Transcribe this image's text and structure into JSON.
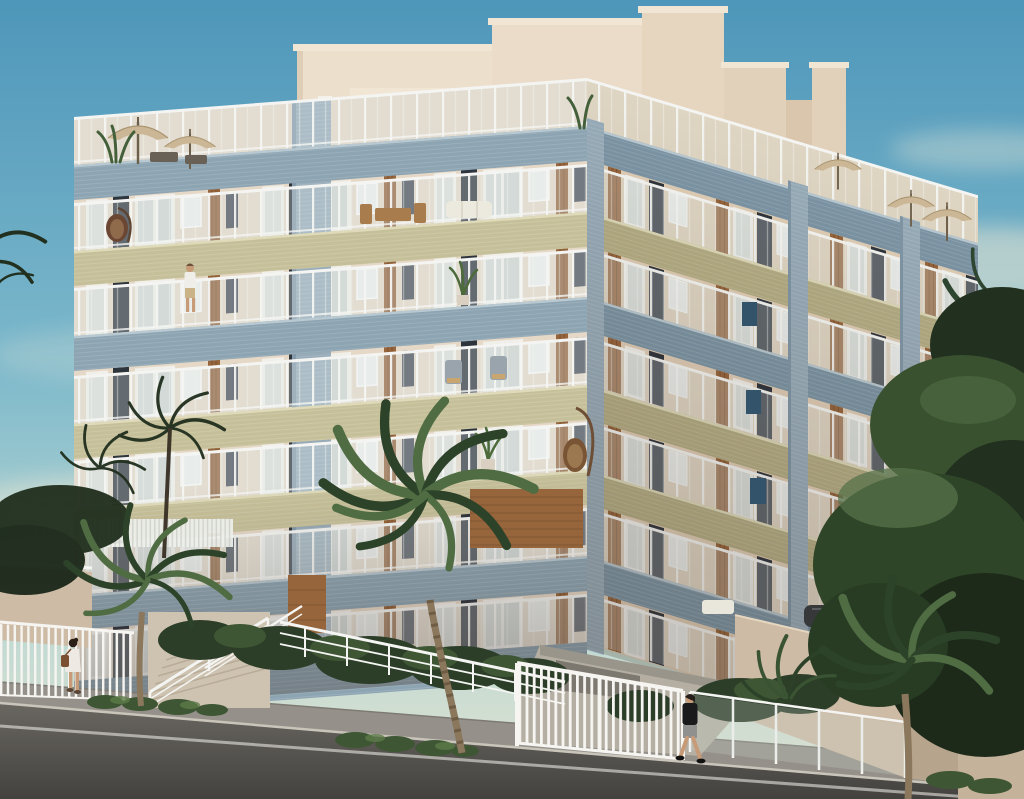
{
  "meta": {
    "type": "architectural-rendering",
    "width": 1024,
    "height": 799
  },
  "scene": {
    "setting": "Seaside apartment building rendering at dusk, corner street view",
    "building": {
      "kind": "multi-storey residential apartment block",
      "floors_visible": 7,
      "view": "two facades from street corner",
      "rooftop_terrace": true,
      "balcony_band_sequence": [
        "blue",
        "olive",
        "blue",
        "olive",
        "olive",
        "blue",
        "blue"
      ],
      "railing_style": "white posts with glass panels",
      "materials": [
        "cream brick",
        "blue-gray mosaic tile",
        "olive mosaic tile",
        "wood slat panels"
      ]
    },
    "rooftop": {
      "umbrellas": 5,
      "umbrella_color": "tan",
      "plants": true,
      "outdoor_furniture": true
    },
    "people": [
      {
        "id": "woman-walking",
        "description": "woman in white dress with brown shoulder bag walking on left sidewalk"
      },
      {
        "id": "man-walking",
        "description": "man in black t-shirt and gray shorts walking past entrance gate"
      },
      {
        "id": "man-on-balcony",
        "description": "man in white shirt standing on upper balcony"
      }
    ],
    "balcony_items": [
      "hanging egg chair",
      "tall-stand egg chair",
      "potted plants",
      "wooden dining set",
      "white sofa",
      "lounge chairs"
    ],
    "vegetation": {
      "foreground_palms": 3,
      "distant_palms": true,
      "dense_trees_right": true,
      "shrub_rows": true
    },
    "street": {
      "road": "asphalt with white edge line",
      "sidewalk": true,
      "stairs_to_entrance": true,
      "driveway_ramp": true,
      "parked_car_partially_hidden": true,
      "fences": [
        "white vertical-bar fence",
        "white entrance gate",
        "three-rail ramp railing",
        "glass panel fence"
      ]
    },
    "sky": {
      "condition": "clear with soft warm clouds"
    }
  },
  "palette": {
    "skyTop": "#4e96ba",
    "skyMid": "#7cb8cb",
    "skyLow": "#b9d7d2",
    "horizon": "#e2e3d2",
    "cloud": "#f0edda",
    "wallFront": "#e6d8c6",
    "wallFrontDark": "#d6c5ae",
    "wallRight": "#dfcdb5",
    "wallRightDark": "#c9b59b",
    "roofCream": "#ecdfcc",
    "roofShade": "#d9c5a9",
    "slab": "#f1e6d4",
    "bandBlue": "#8da4b2",
    "bandBlueDark": "#7b94a4",
    "bandBlueLite": "#b9c9d1",
    "bandOlive": "#c6c09a",
    "bandOliveDark": "#b3ac83",
    "bandOliveLite": "#dedaba",
    "colBlue": "#97abb8",
    "railWhite": "#f4f5f2",
    "glass": "#dfe9ea",
    "winDark": "#2e343c",
    "winDark2": "#454b54",
    "doorWhite": "#f1efe9",
    "wood": "#96653c",
    "woodDark": "#714a2b",
    "terrWall": "#cdbba5",
    "terrWallDark": "#b7a48d",
    "steps": "#cec3b1",
    "path": "#b5afa3",
    "ramp": "#7d786f",
    "sidewalk": "#95918a",
    "curb": "#c9c5ba",
    "road": "#6b6862",
    "roadDark": "#44423f",
    "roadLine": "#e8e6e0",
    "fenceWhite": "#f6f5f1",
    "shrubDark": "#2c3d28",
    "shrubMid": "#3e5634",
    "shrubLite": "#5d7b49",
    "palmLit": "#4f6c42",
    "palmDark": "#2c4229",
    "trunk": "#8a775c",
    "treeDark": "#22301f",
    "treeMid": "#39512f",
    "treeLite": "#55714a",
    "umbrella": "#cbb795",
    "umbrellaDark": "#a99470",
    "skin": "#c79b78",
    "dressWhite": "#efe9e4",
    "khaki": "#c9b387",
    "shirtBlack": "#1a191c",
    "shortsGray": "#90908e",
    "bag": "#7a4f32",
    "carDark": "#36383a",
    "accentNavy": "#33536b"
  }
}
